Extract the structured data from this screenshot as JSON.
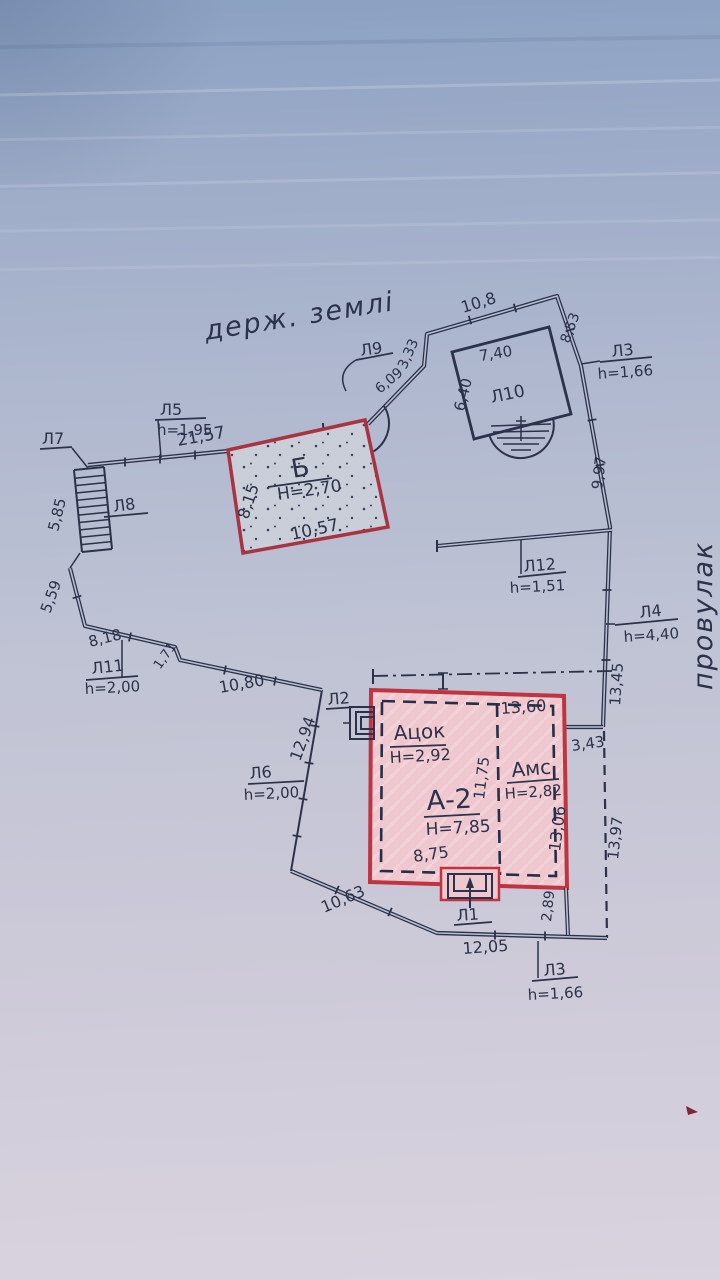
{
  "annotations": {
    "land_note": "держ. землі",
    "street": "провулак"
  },
  "buildings": {
    "b": {
      "label": "Б",
      "height": "H=2,70",
      "dim_side": "8,15",
      "dim_bottom": "10,57"
    },
    "a2": {
      "label": "А-2",
      "height": "H=7,85",
      "basement_label": "Ацок",
      "basement_height": "H=2,92",
      "annex_label": "Амс",
      "annex_height": "H=2,82",
      "dim_top": "13,60",
      "dim_center": "11,75",
      "dim_right": "13,06",
      "dim_bottom": "8,75"
    },
    "l10": {
      "label": "Л10",
      "dim_top": "7,40",
      "dim_side": "6,40"
    }
  },
  "points": {
    "l1": {
      "label": "Л1"
    },
    "l2": {
      "label": "Л2"
    },
    "l3_top": {
      "label": "Л3",
      "height": "h=1,66"
    },
    "l3_bottom": {
      "label": "Л3",
      "height": "h=1,66"
    },
    "l4": {
      "label": "Л4",
      "height": "h=4,40"
    },
    "l5": {
      "label": "Л5",
      "height": "h=1,95"
    },
    "l6": {
      "label": "Л6",
      "height": "h=2,00"
    },
    "l7": {
      "label": "Л7"
    },
    "l8": {
      "label": "Л8"
    },
    "l9": {
      "label": "Л9"
    },
    "l11": {
      "label": "Л11",
      "height": "h=2,00"
    },
    "l12": {
      "label": "Л12",
      "height": "h=1,51"
    }
  },
  "dims": {
    "d21_57": "21,57",
    "d5_85": "5,85",
    "d5_59": "5,59",
    "d8_18": "8,18",
    "d1_71": "1,71",
    "d10_80": "10,80",
    "d12_94": "12,94",
    "d10_63": "10,63",
    "d12_05": "12,05",
    "d2_89": "2,89",
    "d13_97": "13,97",
    "d3_43": "3,43",
    "d13_45": "13,45",
    "d9_97": "9,97",
    "d8_53": "8,53",
    "d10_8": "10,8",
    "d3_33": "3,33",
    "d6_09": "6,09"
  },
  "colors": {
    "ink": "#2b3249",
    "building_a2_border": "#bf3440",
    "building_b_border": "#a93340",
    "building_a2_fill": "#efc7ce",
    "building_b_fill": "#c9ced9",
    "paper_top": "#8ba1c2",
    "paper_bottom": "#d9d3de"
  }
}
